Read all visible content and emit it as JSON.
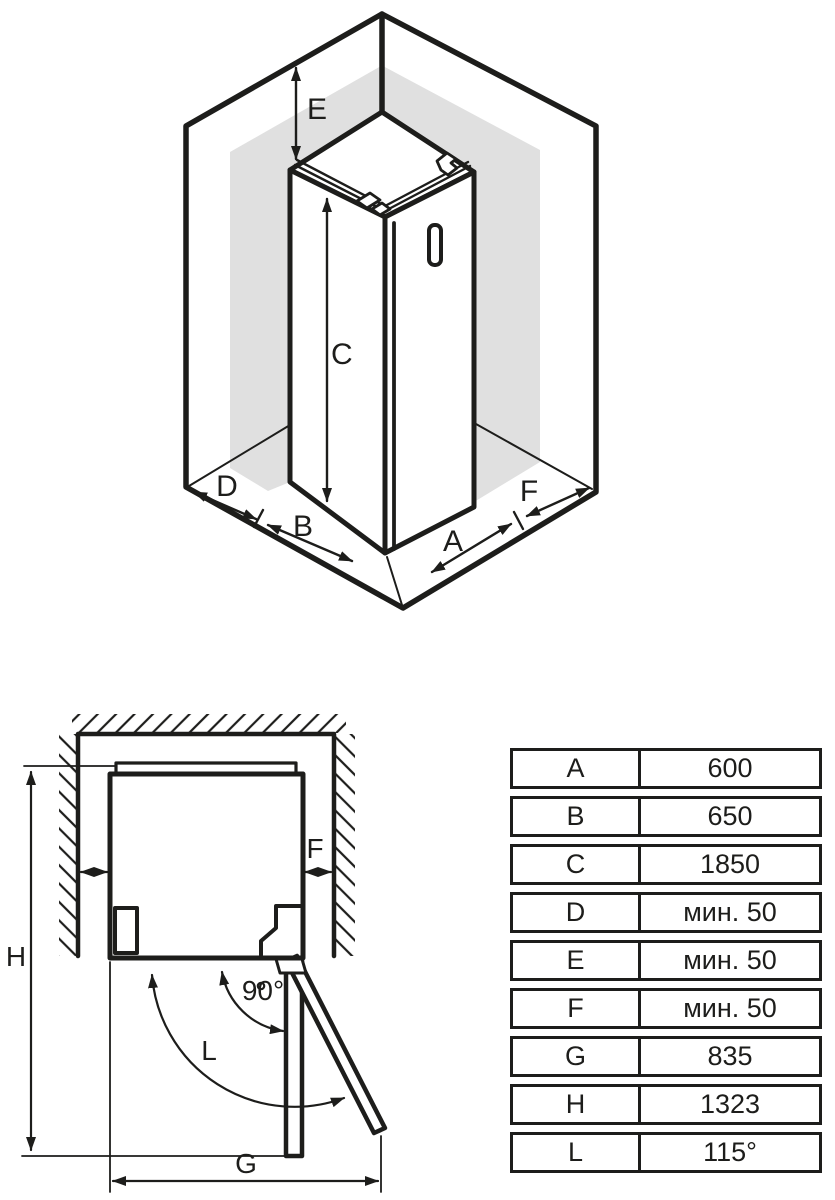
{
  "colors": {
    "line": "#1d1d1b",
    "shade": "#e0e0e0",
    "background": "#ffffff"
  },
  "isometric_view": {
    "labels": {
      "e": "E",
      "c": "C",
      "d": "D",
      "b": "B",
      "a": "A",
      "f": "F"
    }
  },
  "plan_view": {
    "labels": {
      "h": "H",
      "f": "F",
      "angle_90": "90°",
      "l": "L",
      "g": "G"
    }
  },
  "dimensions_table": {
    "rows": [
      {
        "key": "A",
        "value": "600"
      },
      {
        "key": "B",
        "value": "650"
      },
      {
        "key": "C",
        "value": "1850"
      },
      {
        "key": "D",
        "value": "мин. 50"
      },
      {
        "key": "E",
        "value": "мин. 50"
      },
      {
        "key": "F",
        "value": "мин. 50"
      },
      {
        "key": "G",
        "value": "835"
      },
      {
        "key": "H",
        "value": "1323"
      },
      {
        "key": "L",
        "value": "115°"
      }
    ]
  }
}
